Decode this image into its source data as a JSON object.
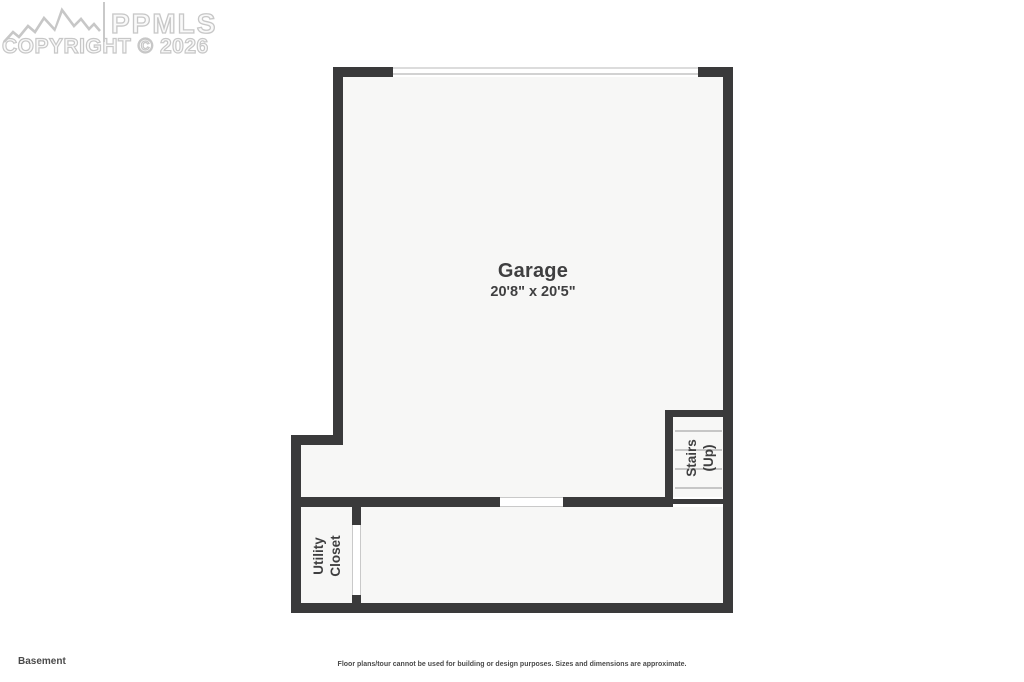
{
  "watermark": {
    "logo": "mountain-range-logo",
    "brand": "PPMLS",
    "copyright_line": "COPYRIGHT © 2026"
  },
  "plan": {
    "rooms": {
      "garage": {
        "name": "Garage",
        "dimensions": "20'8\" x 20'5\""
      },
      "stairs": {
        "line1": "Stairs",
        "line2": "(Up)"
      },
      "utility_closet": {
        "line1": "Utility",
        "line2": "Closet"
      }
    },
    "features": [
      "garage-door-opening",
      "interior-door-opening",
      "closet-door-opening",
      "stair-treads"
    ]
  },
  "footer": {
    "floor_label": "Basement",
    "disclaimer": "Floor plans/tour cannot be used for building or design purposes. Sizes and dimensions are approximate."
  },
  "colors": {
    "background": "#ffffff",
    "floor": "#f7f7f6",
    "wall": "#3a3a3b",
    "thin_line": "#c6c6c6",
    "label_text": "#3f3f40",
    "watermark": "#c7c7c7"
  }
}
